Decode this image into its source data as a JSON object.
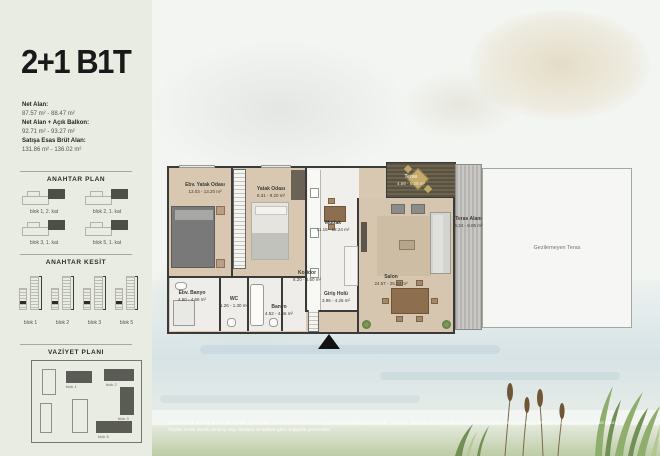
{
  "colors": {
    "panel_bg": "#e9ece3",
    "wall": "#3a3a3a",
    "wood_floor": "#d9c8b1",
    "dark_deck": "#5a523f",
    "accent_dark": "#191919"
  },
  "panel": {
    "title": "2+1 B1T",
    "areas": [
      {
        "label": "Net Alan:",
        "value": "87.57 m² - 88.47 m²"
      },
      {
        "label": "Net Alan + Açık Balkon:",
        "value": "92.71 m² - 93.27 m²"
      },
      {
        "label": "Satışa Esas Brüt Alan:",
        "value": "131.86 m² - 136.02 m²"
      }
    ],
    "anahtar_plan": {
      "title": "ANAHTAR PLAN",
      "items": [
        "blok 1, 2. kat",
        "blok 2, 1. kat",
        "blok 3, 1. kat",
        "blok 5, 1. kat"
      ]
    },
    "anahtar_kesit": {
      "title": "ANAHTAR KESİT",
      "items": [
        "blok 1",
        "blok 2",
        "blok 3",
        "blok 5"
      ]
    },
    "vaziyet_plani": {
      "title": "VAZİYET PLANI",
      "labels": [
        "blok 1",
        "blok 2",
        "blok 3",
        "blok 5"
      ]
    }
  },
  "plan": {
    "rooms": {
      "master_bedroom": {
        "name": "Ebv. Yatak Odası",
        "area": "13.03 - 13.20 m²"
      },
      "bedroom": {
        "name": "Yatak Odası",
        "area": "8.31 - 9.20 m²"
      },
      "kitchen": {
        "name": "Mutfak",
        "area": "11.15 - 12.24 m²"
      },
      "living_room": {
        "name": "Salon",
        "area": "24.57 - 25.33 m²"
      },
      "terrace": {
        "name": "Teras",
        "area": "4.69 - 5.29 m²"
      },
      "terrace_area": {
        "name": "Teras Alanı",
        "area": "6.24 - 8.05 m²"
      },
      "non_walkable_terrace": {
        "name": "Gezilemeyen Teras"
      },
      "corridor": {
        "name": "Koridor",
        "area": "6.20 - 6.50 m²"
      },
      "master_bath": {
        "name": "Ebv. Banyo",
        "area": "4.60 - 4.66 m²"
      },
      "wc": {
        "name": "WC",
        "area": "1.26 - 1.30 m²"
      },
      "bathroom": {
        "name": "Banyo",
        "area": "4.52 - 4.66 m²"
      },
      "entry_hall": {
        "name": "Giriş Holü",
        "area": "3.96 - 4.26 m²"
      }
    }
  },
  "footer": {
    "line1": "Örnek olarak alınmış bu kat planındaki daire tipleri ve katlardaki yerleşimleri uygulamada farklılık gösterebilir. Yüklenici, projenin uygulanması sırasında teknik açıdan gerekli gördüğü değişiklikleri yapma hakkını saklı tutar.",
    "line2": "Ölçüler örnek olarak verilmiş olup, bloklara ve katlara göre değişiklik gösterebilir."
  }
}
